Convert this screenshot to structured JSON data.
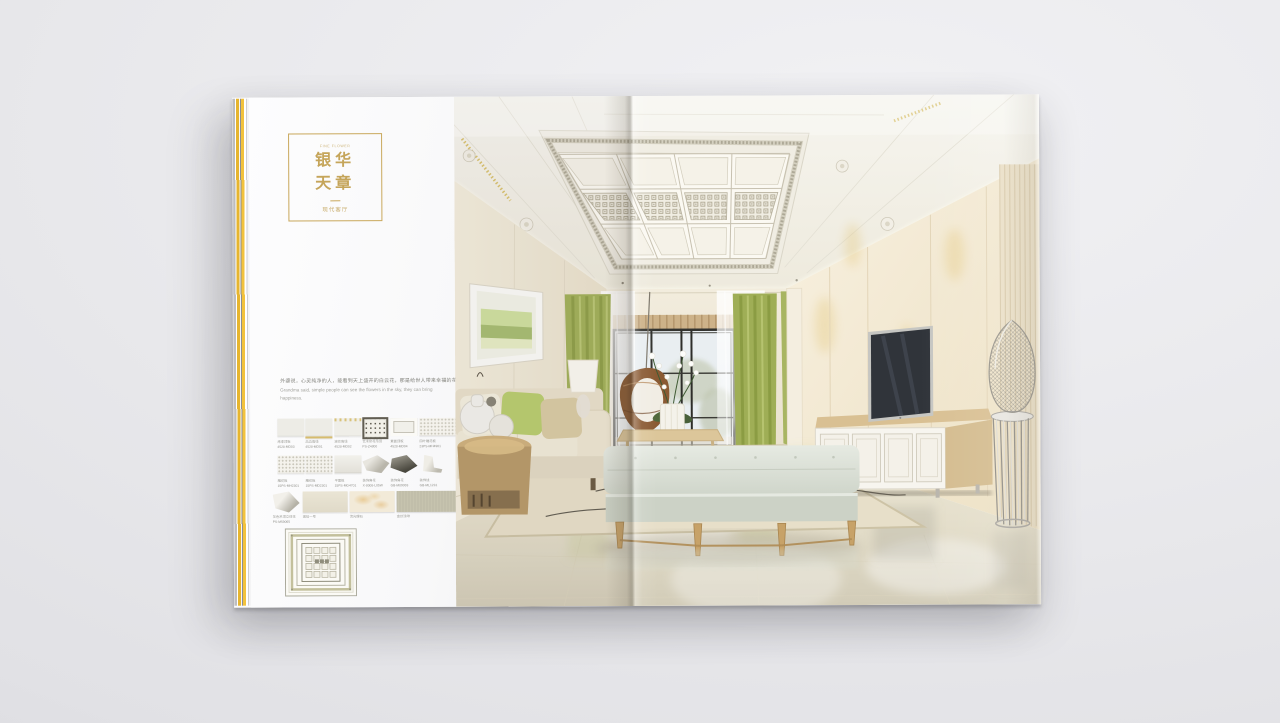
{
  "accent": {
    "gold": "#c2a35b",
    "edge_yellow": "#e9b832",
    "curtain_green": "#a3b15c",
    "surface": "#e9e9ec"
  },
  "book": {
    "left_page": {
      "eyebrow": "FINE FLOWER",
      "title_line1": "银华",
      "title_line2": "天章",
      "divider": "—",
      "subtitle": "现代客厅",
      "intro_zh": "外婆说，心灵纯净的人，能看到天上盛开的白云花，那是给世人带来幸福的花。",
      "intro_en_1": "Grandma said, simple people can see the flowers in the sky, they can bring",
      "intro_en_2": "happiness.",
      "swatch_row1": [
        {
          "name": "烤漆顶板",
          "code": "4528-MD03"
        },
        {
          "name": "高边角线",
          "code": "4528-MD01"
        },
        {
          "name": "波纹角线",
          "code": "4528-MD02"
        },
        {
          "name": "艺术印花吊顶",
          "code": "PS-Z4800"
        },
        {
          "name": "素面顶板",
          "code": "4528-MD04"
        },
        {
          "name": "四叶雕花板",
          "code": "23PS-MH4901"
        }
      ],
      "swatch_row2": [
        {
          "name": "雕花板",
          "code": "15PS-MH2301"
        },
        {
          "name": "雕花板",
          "code": "15PS-MD2301"
        },
        {
          "name": "平面板",
          "code": "15PS-MG4701"
        },
        {
          "name": "装饰角花",
          "code": "X-8008-L05W"
        },
        {
          "name": "装饰角花",
          "code": "GB-M09083"
        },
        {
          "name": "装饰线",
          "code": "GB-ML1231"
        }
      ],
      "swatch_row3": [
        {
          "name": "灰色吊顶立体花",
          "code": "PS-M59065"
        },
        {
          "name": "琥珀一号",
          "code": ""
        },
        {
          "name": "流光理石",
          "code": ""
        },
        {
          "name": "金丝浅啡",
          "code": ""
        }
      ]
    }
  }
}
